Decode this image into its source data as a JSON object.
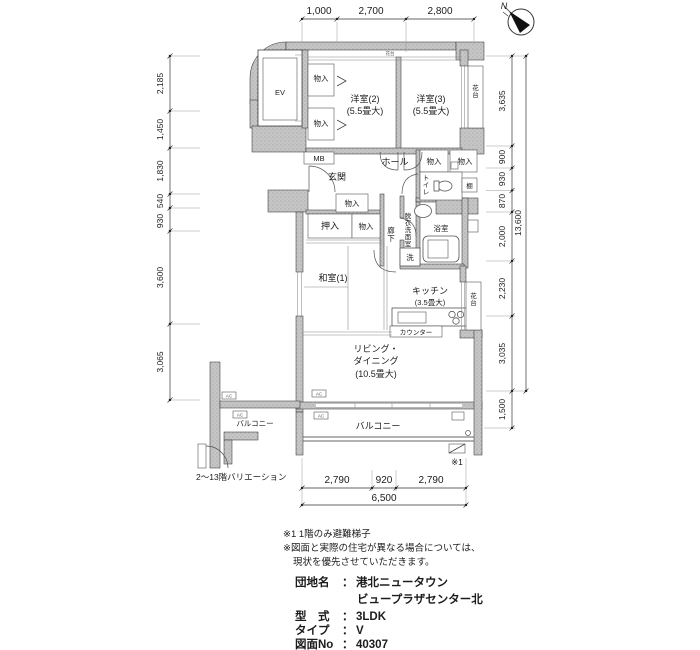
{
  "plan": {
    "compass": {
      "north": "N"
    },
    "rooms": {
      "ev": "EV",
      "mb": "MB",
      "western2_name": "洋室(2)",
      "western2_size": "(5.5畳大)",
      "western3_name": "洋室(3)",
      "western3_size": "(5.5畳大)",
      "japanese1_name": "和室(1)",
      "kitchen_name": "キッチン",
      "kitchen_size": "(3.5畳大)",
      "living_line1": "リビング・",
      "living_line2": "ダイニング",
      "living_size": "(10.5畳大)",
      "entrance": "玄関",
      "hall": "ホール",
      "corridor": "廊下",
      "toilet": "トイレ",
      "shelf": "棚",
      "bathroom": "浴室",
      "washroom": "脱衣洗面室",
      "washer": "洗",
      "storage": "物入",
      "closet": "押入",
      "counter": "カウンター",
      "flower_stand": "花台",
      "balcony": "バルコニー",
      "ac_unit": "AC"
    },
    "dimensions": {
      "top": [
        "1,000",
        "2,700",
        "2,800"
      ],
      "bottom": [
        "2,790",
        "920",
        "2,790"
      ],
      "bottom_total": "6,500",
      "left": [
        "2,185",
        "1,450",
        "1,830",
        "540",
        "930",
        "3,600",
        "3,065"
      ],
      "right": [
        "3,635",
        "900",
        "930",
        "870",
        "2,000",
        "2,230",
        "3,035"
      ],
      "right_balcony": "1,500",
      "right_total": "13,600"
    },
    "marks": {
      "hatch_ref": "※1"
    },
    "inset": {
      "caption": "2〜13階バリエーション"
    }
  },
  "notes": {
    "line1": "※1 1階のみ避難梯子",
    "line2": "※図面と実際の住宅が異なる場合については、",
    "line3": "現状を優先させていただきます。"
  },
  "info": {
    "separator": "：",
    "rows": [
      {
        "label": "団地名",
        "value": "港北ニュータウン",
        "value2": "ビュープラザセンター北"
      },
      {
        "label": "型　式",
        "value": "3LDK"
      },
      {
        "label": "タイプ",
        "value": "V"
      },
      {
        "label": "図面No",
        "value": "40307"
      }
    ]
  }
}
